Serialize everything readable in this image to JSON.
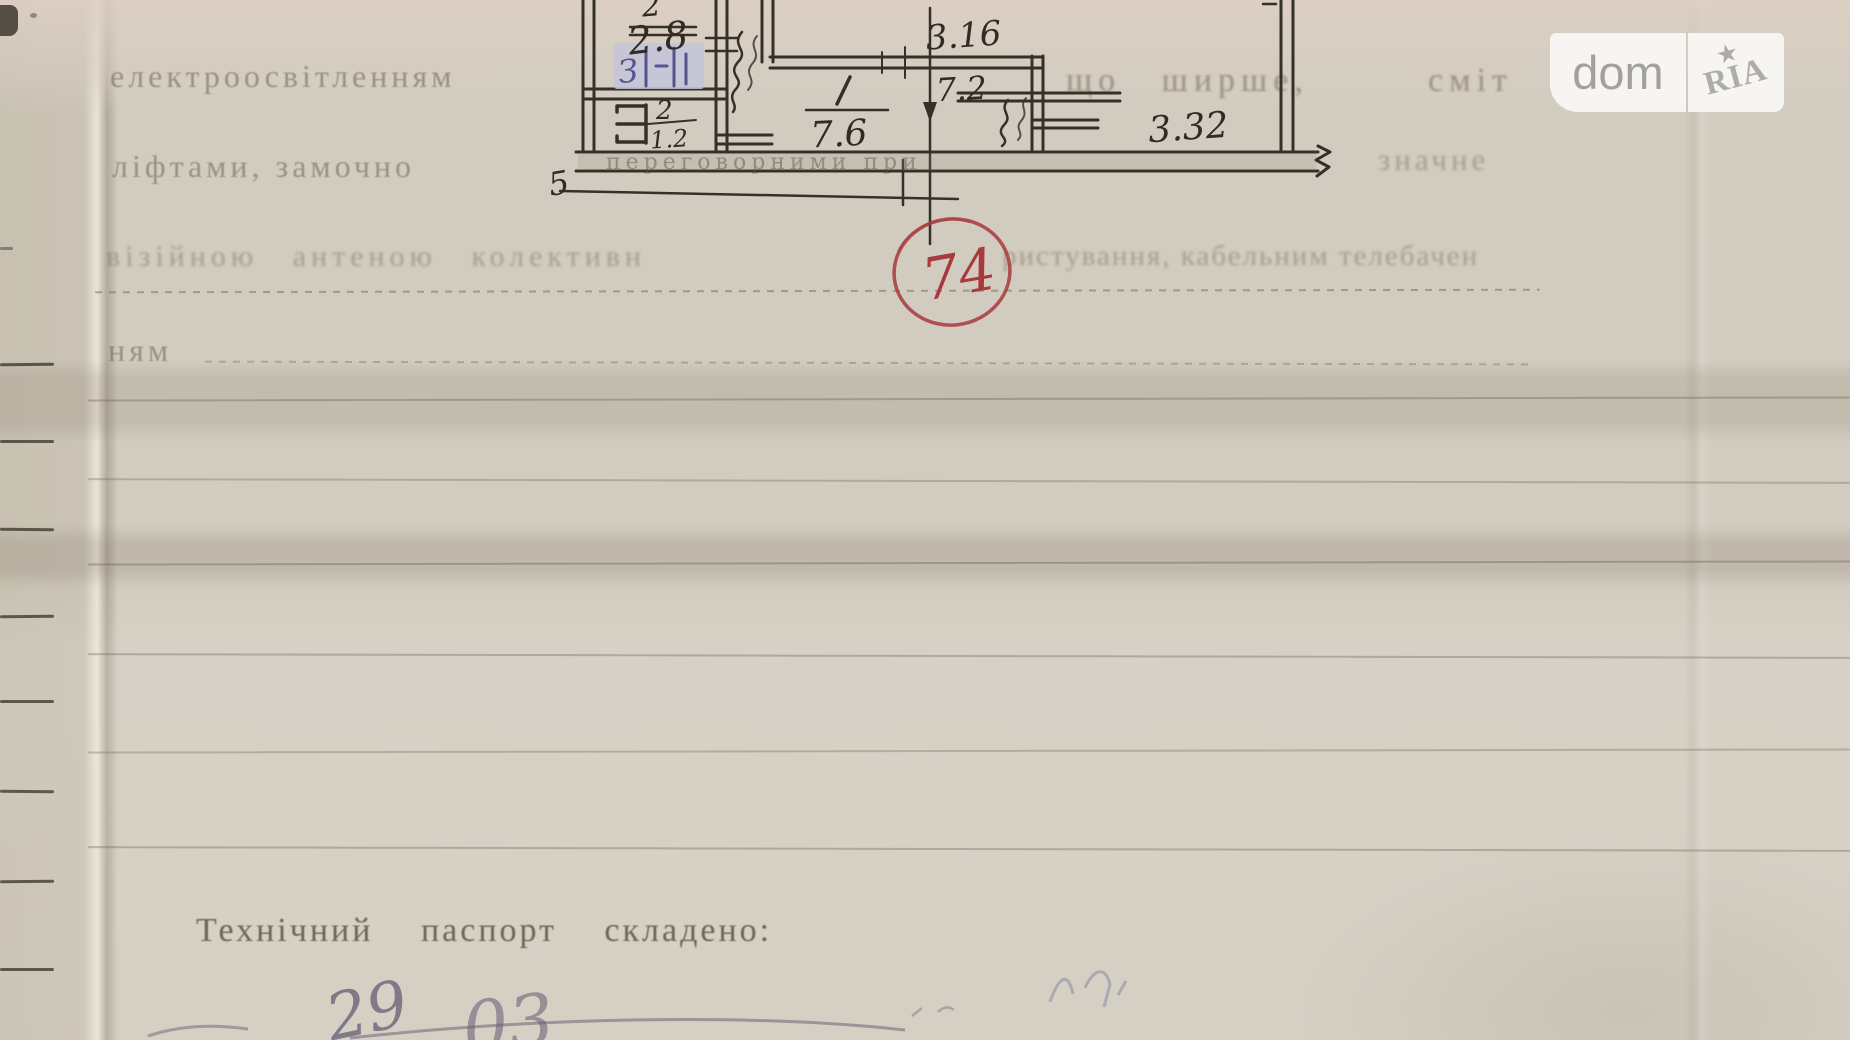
{
  "page": {
    "margin_ticks": [
      363,
      440,
      528,
      615,
      700,
      790,
      880,
      968
    ],
    "ruled_lines": [
      {
        "y": 290,
        "x1": 95,
        "x2": 1540,
        "style": "dotted",
        "opacity": 0.5
      },
      {
        "y": 362,
        "x1": 205,
        "x2": 1530,
        "style": "dotted",
        "opacity": 0.38
      },
      {
        "y": 398,
        "x1": 88,
        "x2": 1850,
        "style": "solid",
        "opacity": 0.42
      },
      {
        "y": 480,
        "x1": 88,
        "x2": 1850,
        "style": "solid",
        "opacity": 0.36
      },
      {
        "y": 562,
        "x1": 88,
        "x2": 1850,
        "style": "solid",
        "opacity": 0.46
      },
      {
        "y": 655,
        "x1": 88,
        "x2": 1850,
        "style": "solid",
        "opacity": 0.4
      },
      {
        "y": 750,
        "x1": 88,
        "x2": 1850,
        "style": "solid",
        "opacity": 0.36
      },
      {
        "y": 848,
        "x1": 88,
        "x2": 1850,
        "style": "solid",
        "opacity": 0.4
      }
    ]
  },
  "typed_text": {
    "line1_left": "електроосвітленням",
    "line1_mid": "що ширше,",
    "line1_right": "сміт",
    "line2_left": "ліфтами,  замочно",
    "line2_band": "переговорними  при",
    "line2_right": "значне",
    "line3_left": "візійною  антеною  колективн",
    "line3_right": "ристування,  кабельним  телебачен",
    "line4": "ням",
    "footer": "Технічний  паспорт  складено:"
  },
  "plan": {
    "labels": {
      "top_partial": "2",
      "room_small": "2.8",
      "blue_note": "З",
      "closet_num": "2",
      "closet_area": "1.2",
      "dim_316": "3.16",
      "room1_area": "7.6",
      "dim_72": "7.2",
      "dim_332": "3.32",
      "section_mark": "5"
    },
    "stamp_number": "74"
  },
  "handwriting": {
    "day": "29",
    "month": "03"
  },
  "watermark": {
    "left": "dom",
    "right": "RIA"
  }
}
